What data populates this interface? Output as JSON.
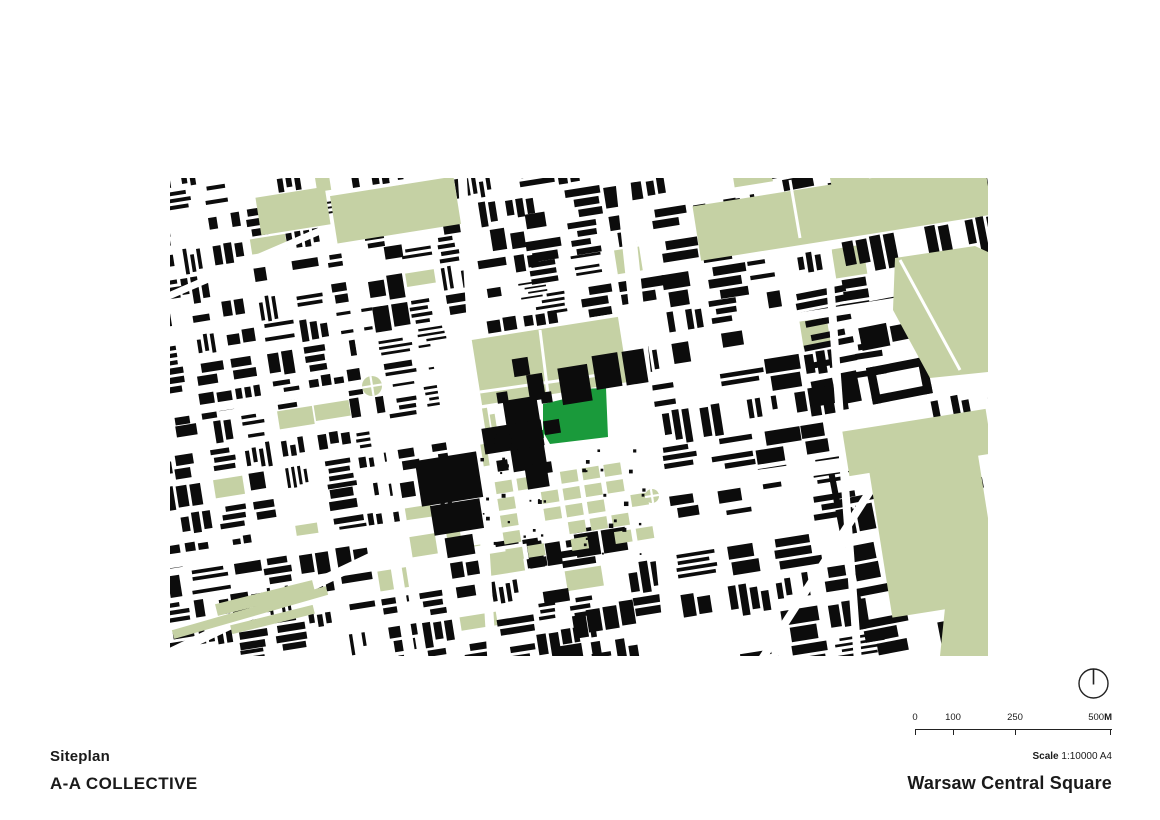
{
  "title_block": {
    "drawing_title": "Siteplan",
    "firm": "A-A COLLECTIVE"
  },
  "footer": {
    "project_title": "Warsaw Central Square",
    "scale_label": "Scale",
    "scale_value": "1:10000 A4"
  },
  "scalebar": {
    "labels": [
      "0",
      "100",
      "250"
    ],
    "end_label": "500",
    "unit": "M",
    "tick_px": [
      0,
      38,
      100,
      196
    ]
  },
  "north_arrow": {
    "shape": "circle-with-needle"
  },
  "map": {
    "width": 818,
    "height": 478,
    "colors": {
      "background": "#ffffff",
      "building": "#0c0c0c",
      "park": "#c5d1a4",
      "site": "#1a9a3b",
      "street": "#ffffff"
    },
    "seed": 9,
    "districts": [
      {
        "x": -40,
        "y": -40,
        "w": 440,
        "h": 560,
        "rot": -9,
        "cell": [
          30,
          22
        ],
        "gap": 7,
        "empty": 0.1,
        "green": 0.07,
        "perim": 0.25
      },
      {
        "x": 360,
        "y": -40,
        "w": 330,
        "h": 250,
        "rot": -9,
        "cell": [
          36,
          26
        ],
        "gap": 7,
        "empty": 0.09,
        "green": 0.05,
        "perim": 0.3
      },
      {
        "x": 650,
        "y": -40,
        "w": 260,
        "h": 560,
        "rot": -11,
        "cell": [
          48,
          34
        ],
        "gap": 9,
        "empty": 0.11,
        "green": 0.06,
        "perim": 0.6
      },
      {
        "x": 360,
        "y": 230,
        "w": 330,
        "h": 290,
        "rot": -9,
        "cell": [
          40,
          28
        ],
        "gap": 8,
        "empty": 0.1,
        "green": 0.05,
        "perim": 0.45
      }
    ],
    "avenues": [
      {
        "pts": [
          [
            452,
            -6
          ],
          [
            504,
            484
          ]
        ],
        "w": 15
      },
      {
        "pts": [
          [
            -6,
            384
          ],
          [
            824,
            265
          ]
        ],
        "w": 14
      },
      {
        "pts": [
          [
            -6,
            237
          ],
          [
            824,
            109
          ]
        ],
        "w": 9
      },
      {
        "pts": [
          [
            164,
            -6
          ],
          [
            241,
            484
          ]
        ],
        "w": 11
      },
      {
        "pts": [
          [
            292,
            -6
          ],
          [
            322,
            484
          ]
        ],
        "w": 9
      },
      {
        "pts": [
          [
            652,
            -6
          ],
          [
            688,
            484
          ]
        ],
        "w": 8
      },
      {
        "pts": [
          [
            590,
            484
          ],
          [
            742,
            248
          ]
        ],
        "w": 8
      },
      {
        "pts": [
          [
            -6,
            478
          ],
          [
            200,
            380
          ]
        ],
        "w": 10
      },
      {
        "pts": [
          [
            -6,
            120
          ],
          [
            180,
            40
          ]
        ],
        "w": 7
      }
    ],
    "clearing": [
      275,
      147,
      212,
      207,
      -9
    ],
    "specks": {
      "region": [
        285,
        268,
        195,
        108
      ],
      "count": 42
    },
    "parks": {
      "rects": [
        [
          163,
          8,
          125,
          48,
          -9
        ],
        [
          88,
          14,
          70,
          38,
          -9
        ],
        [
          525,
          5,
          295,
          55,
          -9
        ],
        [
          306,
          150,
          148,
          66,
          -9
        ],
        [
          675,
          242,
          145,
          45,
          -9
        ],
        [
          710,
          282,
          110,
          150,
          -9
        ],
        [
          45,
          414,
          100,
          12,
          -14
        ],
        [
          60,
          437,
          85,
          9,
          -14
        ],
        [
          0,
          430,
          160,
          9,
          -16
        ],
        [
          314,
          230,
          5,
          26,
          -9
        ],
        [
          322,
          236,
          5,
          30,
          -9
        ],
        [
          312,
          266,
          6,
          22,
          -9
        ]
      ],
      "polys": [
        [
          [
            725,
            80
          ],
          [
            805,
            68
          ],
          [
            818,
            74
          ],
          [
            818,
            194
          ],
          [
            760,
            200
          ],
          [
            723,
            132
          ]
        ],
        [
          [
            780,
            382
          ],
          [
            818,
            367
          ],
          [
            818,
            478
          ],
          [
            770,
            478
          ]
        ]
      ],
      "paths": [
        [
          310,
          214,
          450,
          194,
          3
        ],
        [
          370,
          152,
          378,
          216,
          3
        ],
        [
          620,
          2,
          630,
          60,
          3
        ],
        [
          730,
          82,
          790,
          192,
          3
        ]
      ],
      "plaza": {
        "x": 330,
        "y": 292,
        "w": 150,
        "h": 80,
        "cell": [
          17,
          12
        ],
        "gap": 5,
        "rot": -9,
        "fill": 0.66
      }
    },
    "roundabouts": [
      [
        202,
        208,
        10
      ],
      [
        482,
        318,
        7
      ]
    ],
    "site": {
      "polygon": [
        [
          373,
          226
        ],
        [
          407,
          218
        ],
        [
          407,
          211
        ],
        [
          436,
          210
        ],
        [
          438,
          259
        ],
        [
          380,
          266
        ],
        [
          373,
          254
        ]
      ],
      "extra_rect": [
        366,
        252,
        8,
        8
      ]
    },
    "landmarks": {
      "rot": -9,
      "black_rects": [
        [
          338,
          220,
          34,
          72
        ],
        [
          313,
          246,
          60,
          26
        ],
        [
          358,
          196,
          16,
          26
        ],
        [
          374,
          242,
          16,
          14
        ],
        [
          356,
          286,
          22,
          24
        ],
        [
          327,
          214,
          11,
          11
        ],
        [
          371,
          214,
          11,
          11
        ],
        [
          327,
          282,
          11,
          11
        ],
        [
          371,
          284,
          11,
          11
        ],
        [
          390,
          188,
          30,
          37
        ],
        [
          424,
          176,
          26,
          34
        ],
        [
          454,
          172,
          22,
          34
        ],
        [
          343,
          180,
          16,
          18
        ],
        [
          248,
          278,
          62,
          46
        ],
        [
          262,
          324,
          50,
          30
        ],
        [
          276,
          358,
          28,
          20
        ]
      ],
      "circles": [
        [
          333,
          263,
          9
        ]
      ]
    }
  }
}
